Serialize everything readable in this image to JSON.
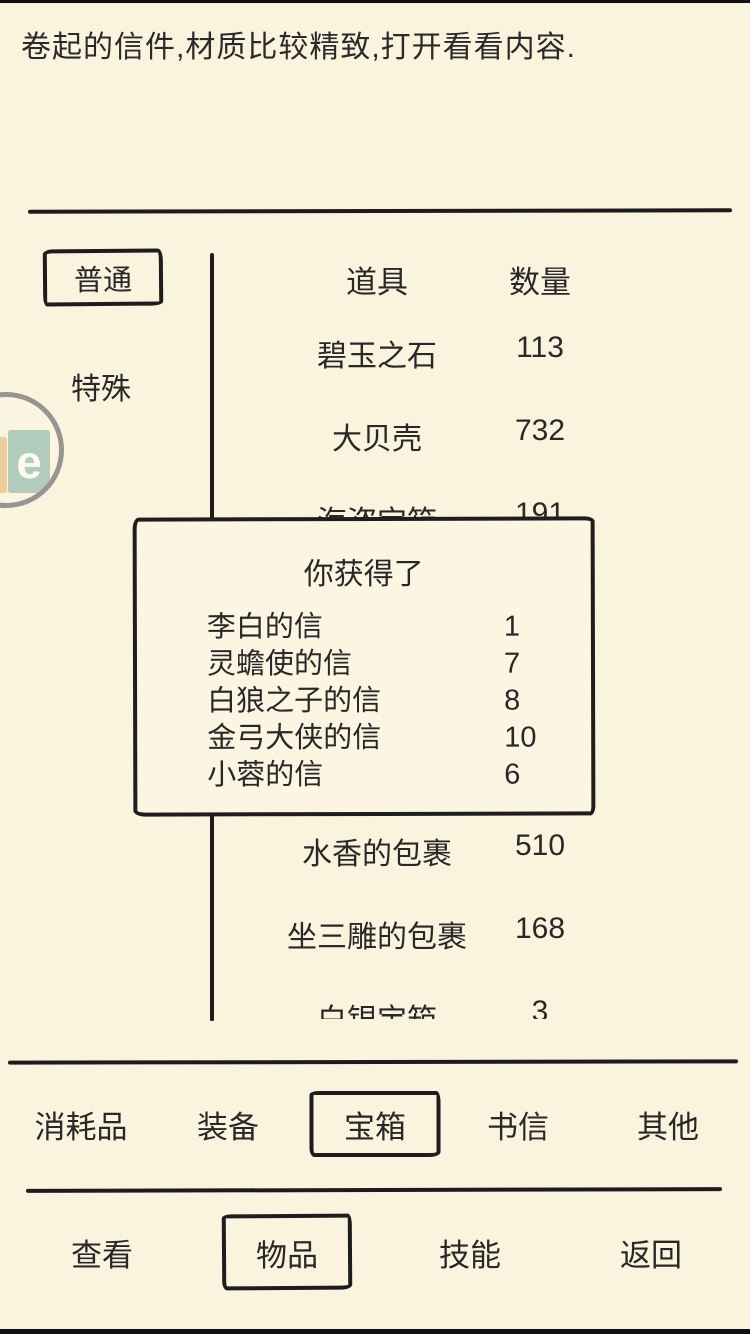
{
  "page": {
    "description": "卷起的信件,材质比较精致,打开看看内容.",
    "colors": {
      "background": "#FAF3DD",
      "ink": "#282828",
      "line": "#1C1C1C",
      "watermark_orange": "#ECC389",
      "watermark_teal": "#A9C7B9"
    }
  },
  "sidebar": {
    "tabs": [
      {
        "label": "普通",
        "selected": true
      },
      {
        "label": "特殊",
        "selected": false
      }
    ]
  },
  "inventory": {
    "headers": {
      "item": "道具",
      "qty": "数量"
    },
    "rows": [
      {
        "name": "碧玉之石",
        "qty": "113"
      },
      {
        "name": "大贝壳",
        "qty": "732"
      },
      {
        "name": "海盗宝箱",
        "qty": "191"
      },
      {
        "name": "水香的包裹",
        "qty": "510"
      },
      {
        "name": "坐三雕的包裹",
        "qty": "168"
      },
      {
        "name": "白银宝箱",
        "qty": "3"
      }
    ]
  },
  "popup": {
    "title": "你获得了",
    "items": [
      {
        "name": "李白的信",
        "qty": "1"
      },
      {
        "name": "灵蟾使的信",
        "qty": "7"
      },
      {
        "name": "白狼之子的信",
        "qty": "8"
      },
      {
        "name": "金弓大侠的信",
        "qty": "10"
      },
      {
        "name": "小蓉的信",
        "qty": "6"
      }
    ]
  },
  "category_tabs": {
    "items": [
      {
        "label": "消耗品",
        "selected": false
      },
      {
        "label": "装备",
        "selected": false
      },
      {
        "label": "宝箱",
        "selected": true
      },
      {
        "label": "书信",
        "selected": false
      },
      {
        "label": "其他",
        "selected": false
      }
    ]
  },
  "action_tabs": {
    "items": [
      {
        "label": "查看",
        "selected": false
      },
      {
        "label": "物品",
        "selected": true
      },
      {
        "label": "技能",
        "selected": false
      },
      {
        "label": "返回",
        "selected": false
      }
    ]
  },
  "watermark": {
    "letter": "e"
  }
}
